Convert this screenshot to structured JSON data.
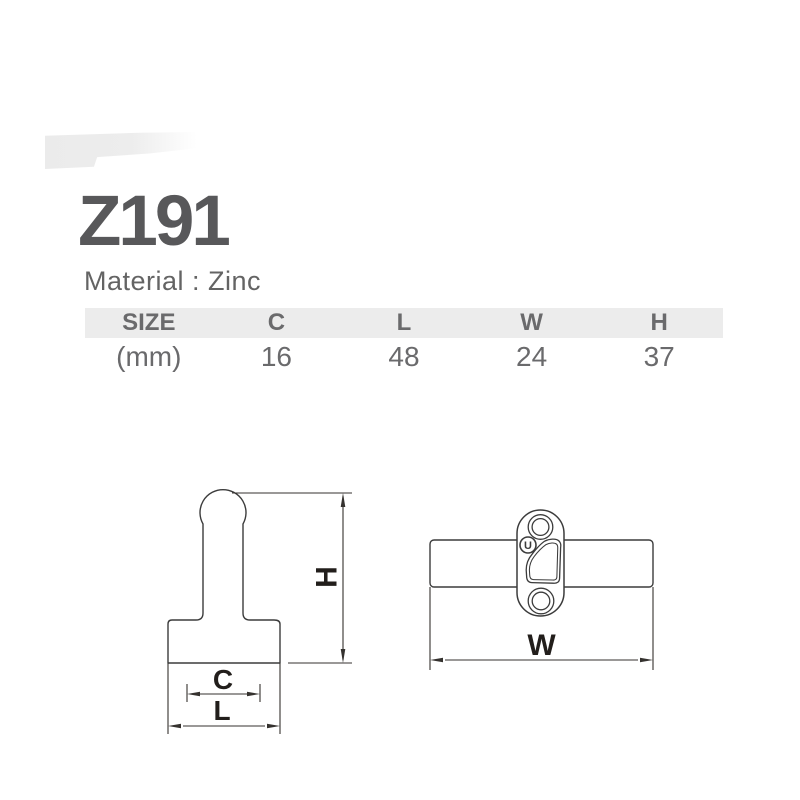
{
  "page": {
    "product_code": "Z191",
    "material_line": "Material : Zinc"
  },
  "spec_table": {
    "headers": [
      "SIZE",
      "C",
      "L",
      "W",
      "H"
    ],
    "unit_row": [
      "(mm)",
      "16",
      "48",
      "24",
      "37"
    ]
  },
  "drawings": {
    "side_view": {
      "dim_height": "H",
      "dim_center": "C",
      "dim_length": "L"
    },
    "front_view": {
      "dim_width": "W",
      "screw_marking": "U"
    }
  },
  "colors": {
    "title_text": "#58585a",
    "body_text": "#646464",
    "table_band": "#ececec",
    "table_text": "#6a6a6c",
    "drawing_line": "#3c3c3c",
    "dimension_text": "#221e1b"
  }
}
